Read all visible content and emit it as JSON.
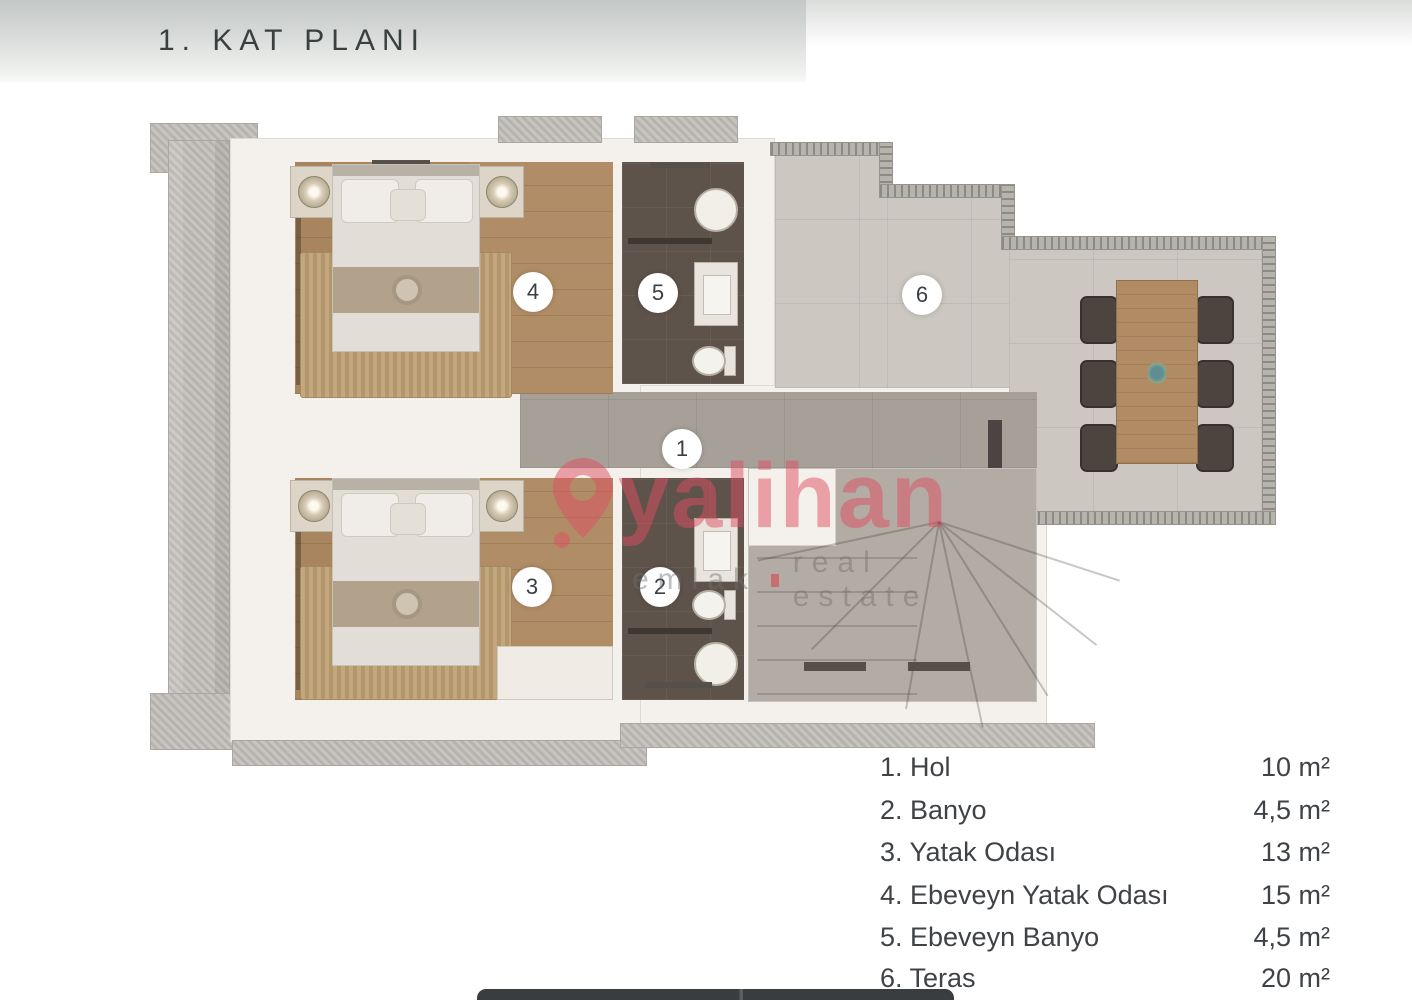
{
  "page": {
    "title": "1. KAT PLANI"
  },
  "watermark": {
    "brand": "yalihan",
    "tagline_left": "emlak",
    "tagline_right": "real estate",
    "brand_color": "#df4d62"
  },
  "plan": {
    "markers": [
      {
        "num": "1"
      },
      {
        "num": "2"
      },
      {
        "num": "3"
      },
      {
        "num": "4"
      },
      {
        "num": "5"
      },
      {
        "num": "6"
      }
    ]
  },
  "legend": {
    "items": [
      {
        "label": "1. Hol",
        "area": "10 m²"
      },
      {
        "label": "2. Banyo",
        "area": "4,5 m²"
      },
      {
        "label": "3. Yatak Odası",
        "area": "13 m²"
      },
      {
        "label": "4. Ebeveyn Yatak Odası",
        "area": "15 m²"
      },
      {
        "label": "5. Ebeveyn Banyo",
        "area": "4,5 m²"
      },
      {
        "label": "6. Teras",
        "area": "20 m²"
      }
    ]
  },
  "colors": {
    "banner_top": "#c3c7c5",
    "wall": "#f4f1ec",
    "wood_floor": "#a8855f",
    "bath_tile": "#5e534b",
    "hall_tile": "#a7a099",
    "terrace_tile": "#ccc7c1",
    "accent_pink": "#df4d62",
    "legend_text": "#3f4347"
  }
}
